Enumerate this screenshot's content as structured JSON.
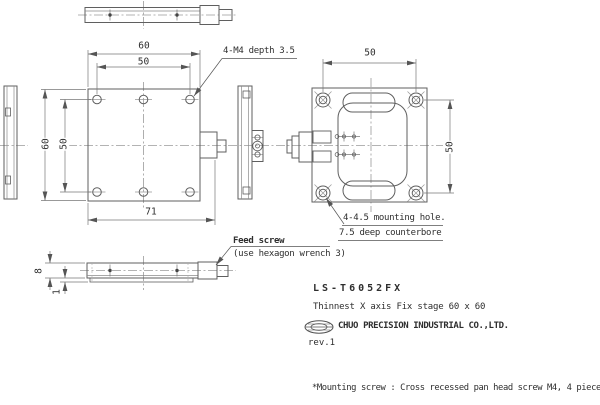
{
  "title_block": {
    "model": "LS-T6052FX",
    "description": "Thinnest X axis Fix stage 60 x 60",
    "company": "CHUO PRECISION INDUSTRIAL CO.,LTD.",
    "revision": "rev.1"
  },
  "footnote": "*Mounting screw : Cross recessed pan head screw M4, 4 pieces",
  "annotations": {
    "tap_hole": "4-M4 depth 3.5",
    "mounting_hole_line1": "4-4.5 mounting hole.",
    "mounting_hole_line2": "7.5 deep counterbore",
    "feed_screw": "Feed screw",
    "feed_screw_note": "(use hexagon wrench 3)"
  },
  "dimensions": {
    "front_top_outer": "60",
    "front_top_inner": "50",
    "front_left_outer": "60",
    "front_left_inner": "50",
    "front_bottom_total": "71",
    "bottom_view_width": "50",
    "bottom_view_height": "50",
    "side_thickness": "8",
    "side_step": "1"
  }
}
